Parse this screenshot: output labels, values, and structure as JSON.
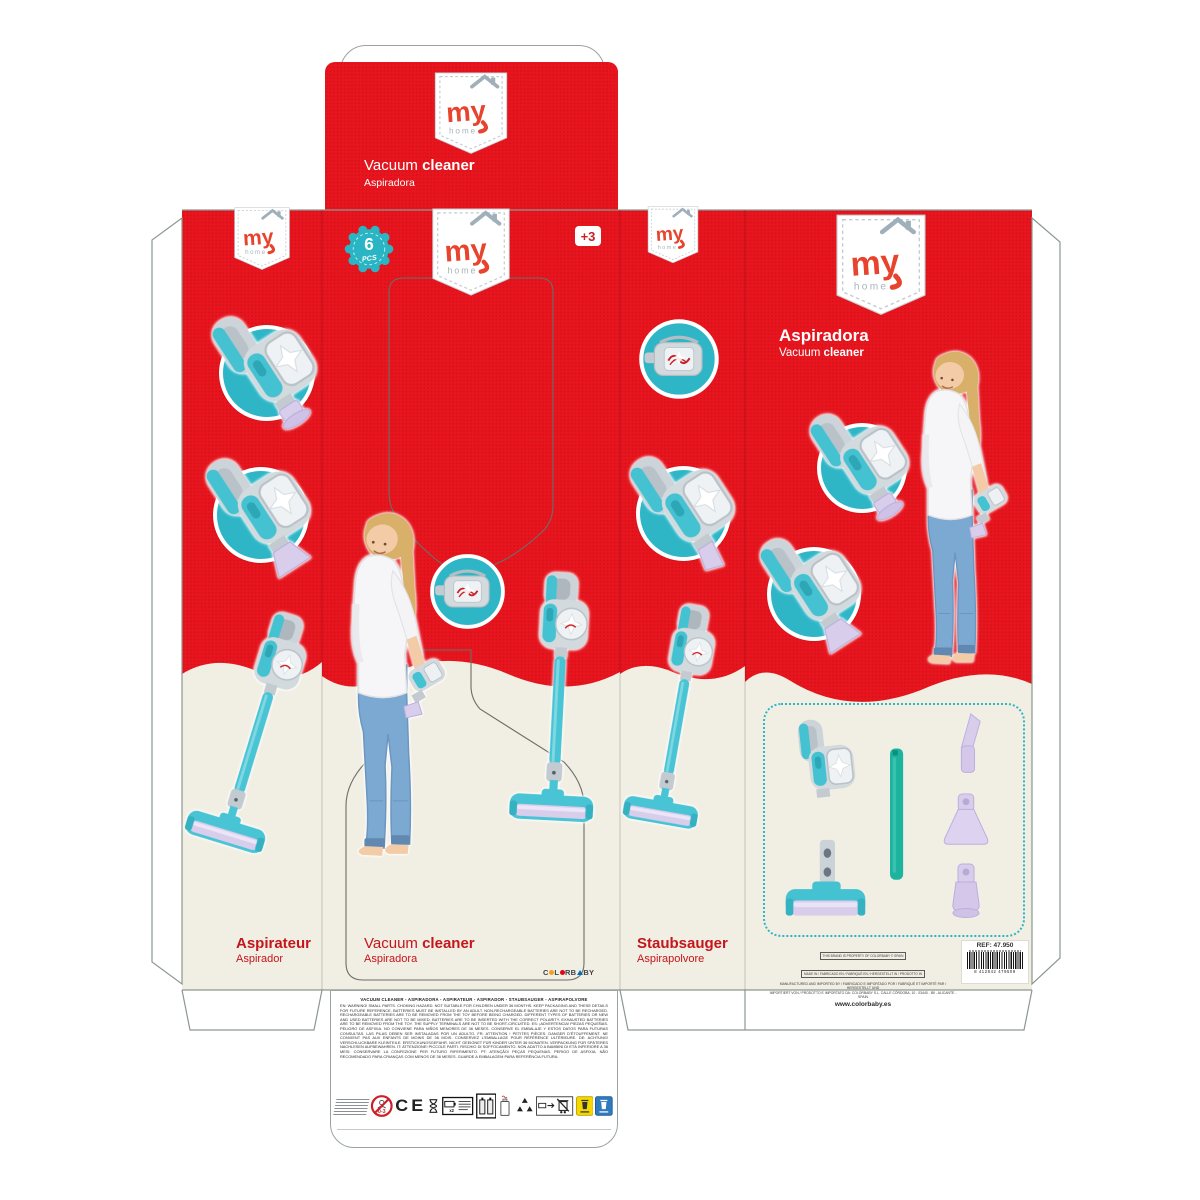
{
  "product": {
    "name_en": "Vacuum cleaner",
    "name_es": "Aspiradora"
  },
  "brand": {
    "my": "my",
    "home": "home",
    "colorbaby": [
      "C",
      "L",
      "R",
      "B",
      "B",
      "Y"
    ]
  },
  "badges": {
    "pieces_value": "6",
    "pieces_unit": "PCS",
    "age": "+3"
  },
  "panels": {
    "top_flap": {
      "title_a": "Vacuum",
      "title_b": "cleaner",
      "subtitle": "Aspiradora"
    },
    "left": {
      "title": "Aspirateur",
      "subtitle": "Aspirador"
    },
    "front": {
      "title_a": "Vacuum",
      "title_b": "cleaner",
      "subtitle": "Aspiradora"
    },
    "side": {
      "title": "Staubsauger",
      "subtitle": "Aspirapolvore"
    },
    "back": {
      "title": "Aspiradora",
      "subtitle_a": "Vacuum",
      "subtitle_b": "cleaner"
    }
  },
  "back_info": {
    "legal_box1": "THIS BRAND IS PROPERTY OF COLORBABY © SPAIN",
    "legal_box2": "MADE IN / FABRICADO EN / FABRIQUÉ EN / HERGESTELLT IN / PRODOTTO IN",
    "legal_line1": "MANUFACTURED AND IMPORTED BY / FABRICADO E IMPORTADO POR / FABRIQUÉ ET IMPORTÉ PAR / HERGESTELLT UND",
    "legal_line2": "IMPORTIERT VON / PRODOTTO E IMPORTATO DA: COLORBABY S.L. CALLE CÓRDOBA, 10 - 03440 - IBI - ALICANTE - SPAIN",
    "website": "www.colorbaby.es",
    "ref": "REF: 47.950",
    "barcode_digits": "8 412842 479509"
  },
  "bottom_flap": {
    "heading": "VACUUM CLEANER - ASPIRADORA - ASPIRATEUR - ASPIRADOR - STAUBSAUGER - ASPIRAPOLVORE",
    "warnings": "EN: WARNING! SMALL PARTS. CHOKING HAZARD. NOT SUITABLE FOR CHILDREN UNDER 36 MONTHS. KEEP PACKAGING AND THESE DETAILS FOR FUTURE REFERENCE. BATTERIES MUST BE INSTALLED BY AN ADULT. NON-RECHARGEABLE BATTERIES ARE NOT TO BE RECHARGED. RECHARGEABLE BATTERIES ARE TO BE REMOVED FROM THE TOY BEFORE BEING CHARGED. DIFFERENT TYPES OF BATTERIES OR NEW AND USED BATTERIES ARE NOT TO BE MIXED. BATTERIES ARE TO BE INSERTED WITH THE CORRECT POLARITY. EXHAUSTED BATTERIES ARE TO BE REMOVED FROM THE TOY. THE SUPPLY TERMINALS ARE NOT TO BE SHORT-CIRCUITED. ES: ¡ADVERTENCIA! PIEZAS PEQUEÑAS. PELIGRO DE ASFIXIA. NO CONVIENE PARA NIÑOS MENORES DE 36 MESES. CONSERVE EL EMBALAJE Y ESTOS DATOS PARA FUTURAS CONSULTAS. LAS PILAS DEBEN SER INSTALADAS POR UN ADULTO. FR: ATTENTION ! PETITES PIÈCES. DANGER D'ÉTOUFFEMENT. NE CONVIENT PAS AUX ENFANTS DE MOINS DE 36 MOIS. CONSERVEZ L'EMBALLAGE POUR RÉFÉRENCE ULTÉRIEURE. DE: ACHTUNG! VERSCHLUCKBARE KLEINTEILE. ERSTICKUNGSGEFAHR. NICHT GEEIGNET FÜR KINDER UNTER 36 MONATEN. VERPACKUNG FÜR SPÄTERES NACHLESEN AUFBEWAHREN. IT: ATTENZIONE! PICCOLE PARTI. RISCHIO DI SOFFOCAMENTO. NON ADATTO A BAMBINI DI ETÀ INFERIORE A 36 MESI. CONSERVARE LA CONFEZIONE PER FUTURO RIFERIMENTO. PT: ATENÇÃO! PEÇAS PEQUENAS. PERIGO DE ASFIXIA. NÃO RECOMENDADO PARA CRIANÇAS COM MENOS DE 36 MESES. GUARDE A EMBALAGEM PARA REFERÊNCIA FUTURA.",
    "ce_mark": "CE",
    "age_warning": "0-3"
  },
  "colors": {
    "red": "#e8151e",
    "teal": "#2eb6c7",
    "cream": "#f1eee3",
    "lilac": "#d9cdec",
    "title_red": "#c4161c"
  }
}
